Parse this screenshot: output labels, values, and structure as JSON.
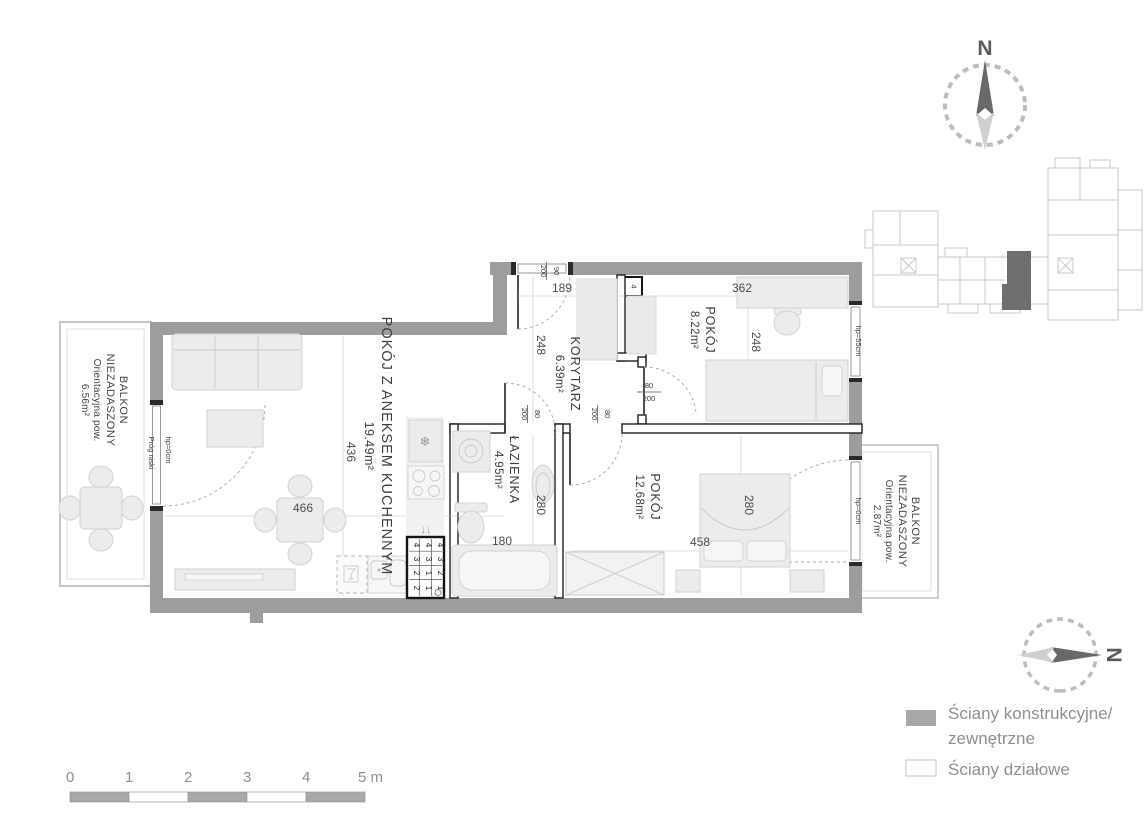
{
  "rooms": [
    {
      "name": "POKÓJ Z ANEKSEM KUCHENNYM",
      "area": "19.49m²"
    },
    {
      "name": "KORYTARZ",
      "area": "6.39m²"
    },
    {
      "name": "POKÓJ",
      "area": "8.22m²"
    },
    {
      "name": "ŁAZIENKA",
      "area": "4.95m²"
    },
    {
      "name": "POKÓJ",
      "area": "12.68m²"
    }
  ],
  "balconies": [
    {
      "name": "BALKON",
      "subtitle": "NIEZADASZONY",
      "note": "Orientacyjna pow.",
      "area": "6.56m²"
    },
    {
      "name": "BALKON",
      "subtitle": "NIEZADASZONY",
      "note": "Orientacyjna pow.",
      "area": "2.87m²"
    }
  ],
  "dimensions": {
    "corridor_width": "189",
    "room_small_width": "362",
    "corridor_depth": "248",
    "room_small_depth": "248",
    "living_depth": "436",
    "living_width": "466",
    "bathroom_depth": "280",
    "bathroom_width": "180",
    "bedroom_depth": "280",
    "bedroom_width": "458"
  },
  "door_dimensions": {
    "entrance_width": "90",
    "entrance_height": "200",
    "interior_width": "80",
    "interior_height": "200"
  },
  "openings": {
    "window_sill_55": "hp=55cm",
    "sill_0_left": "hp=0cm",
    "sill_0_right": "hp=0cm",
    "threshold": "Próg niski",
    "apartment_number": "4"
  },
  "shaft_grid": {
    "rows": [
      [
        "4",
        "4",
        "4"
      ],
      [
        "3",
        "3",
        "3"
      ],
      [
        "2",
        "1",
        "2"
      ],
      [
        "2",
        "1",
        "1"
      ]
    ]
  },
  "icons": {
    "fridge_snowflake": "❄",
    "dishwasher_arrows": "↓↓"
  },
  "compass": {
    "north": "N"
  },
  "scale_bar": {
    "ticks": [
      "0",
      "1",
      "2",
      "3",
      "4"
    ],
    "end_label": "5 m"
  },
  "legend": {
    "items": [
      {
        "line1": "Ściany konstrukcyjne/",
        "line2": "zewnętrzne"
      },
      {
        "line1": "Ściany działowe",
        "line2": ""
      }
    ]
  },
  "colors": {
    "structural_wall": "#9d9d9d",
    "partition_wall": "#ffffff",
    "furniture_fill": "#ececec",
    "unit_highlight": "#6e6e6e",
    "dimension_text": "#4c4c4c"
  }
}
